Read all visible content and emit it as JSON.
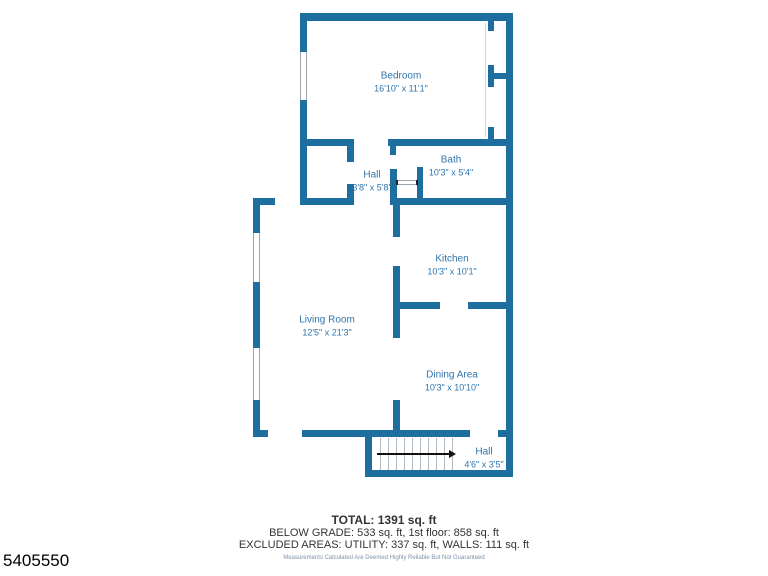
{
  "colors": {
    "wall": "#1e6f9f",
    "label": "#2f74ad",
    "summary_text": "#333333",
    "disclaimer": "#7d93a8",
    "stairs_line": "#b3bac0",
    "arrow": "#111111",
    "id_text": "#000000"
  },
  "rooms": {
    "bedroom": {
      "name": "Bedroom",
      "dims": "16'10\" x 11'1\""
    },
    "hall_upper": {
      "name": "Hall",
      "dims": "3'8\" x 5'8\""
    },
    "bath": {
      "name": "Bath",
      "dims": "10'3\" x 5'4\""
    },
    "kitchen": {
      "name": "Kitchen",
      "dims": "10'3\" x 10'1\""
    },
    "living_room": {
      "name": "Living Room",
      "dims": "12'5\" x 21'3\""
    },
    "dining_area": {
      "name": "Dining Area",
      "dims": "10'3\" x 10'10\""
    },
    "hall_lower": {
      "name": "Hall",
      "dims": "4'6\" x 3'5\""
    }
  },
  "summary": {
    "total": "TOTAL: 1391 sq. ft",
    "line2": "BELOW GRADE: 533 sq. ft, 1st floor: 858 sq. ft",
    "line3": "EXCLUDED AREAS: UTILITY: 337 sq. ft, WALLS: 111 sq. ft",
    "disclaimer": "Measurements Calculated Are Deemed Highly Reliable But Not Guaranteed"
  },
  "listing_id": "5405550"
}
